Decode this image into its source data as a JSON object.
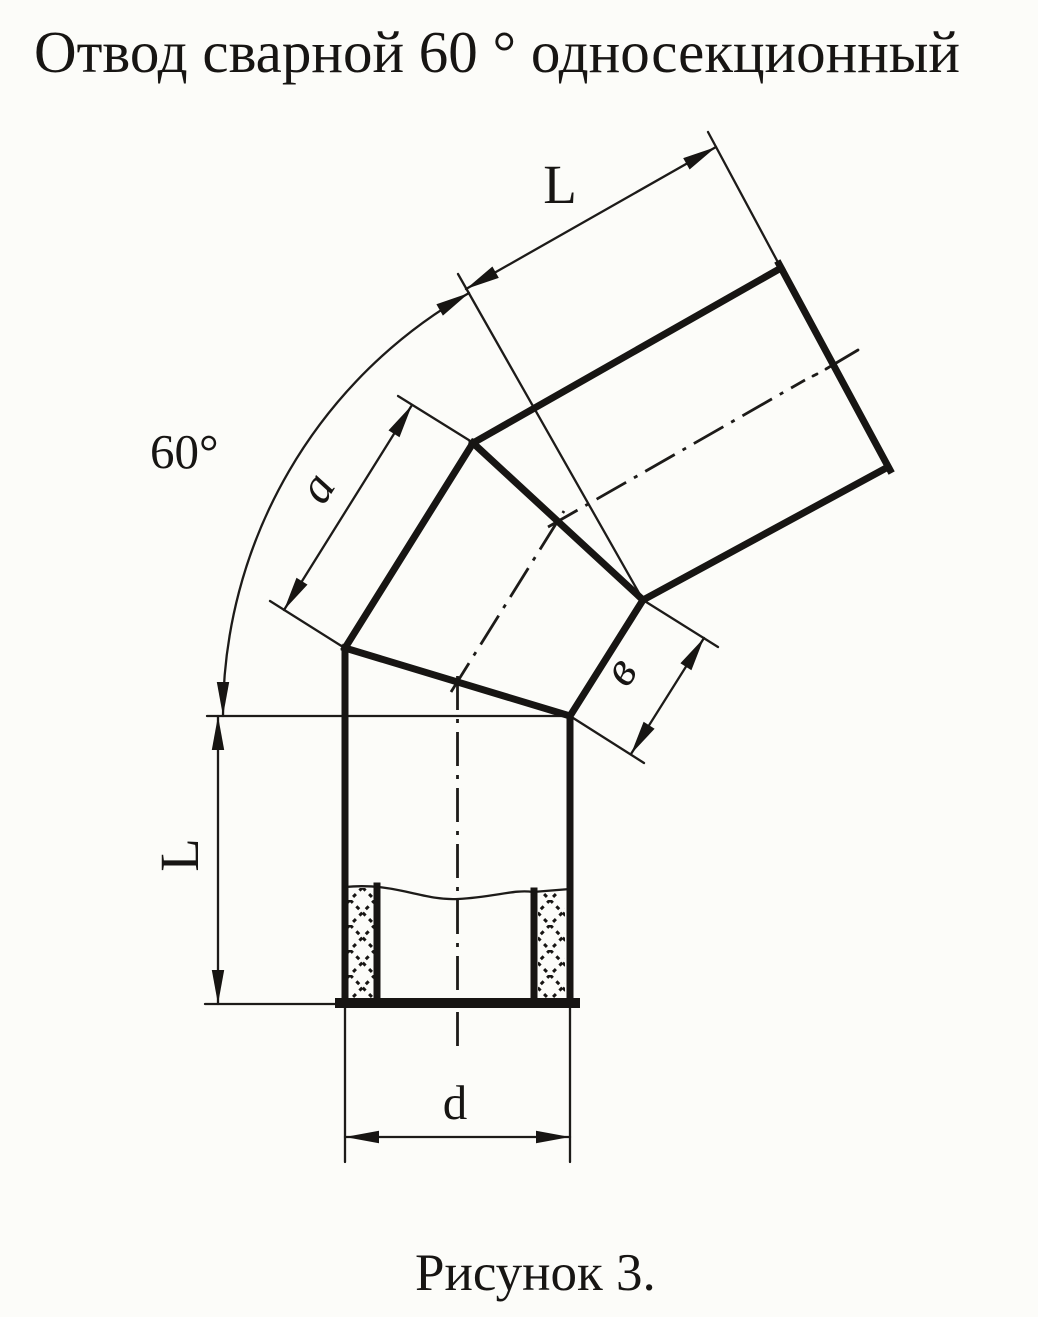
{
  "page": {
    "background": "#fcfcf9",
    "ink": "#171513",
    "description": "Scanned technical drawing of a welded 60-degree single-section pipe elbow"
  },
  "title": "Отвод сварной 60 ° односекционный",
  "caption": "Рисунок 3.",
  "labels": {
    "angle": "60°",
    "length_top": "L",
    "length_bottom": "L",
    "section_a": "a",
    "section_v": "в",
    "diameter": "d"
  }
}
